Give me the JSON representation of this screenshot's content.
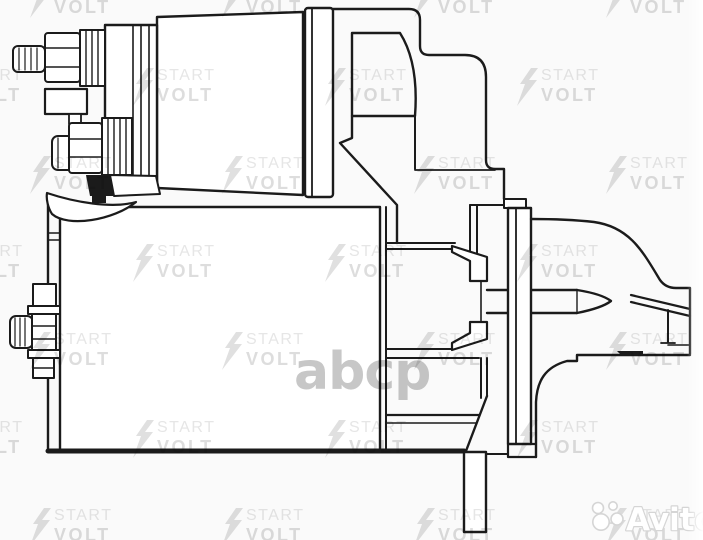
{
  "page": {
    "background": "#fafafa",
    "width": 703,
    "height": 540
  },
  "diagram": {
    "line_color": "#1b1b1b",
    "fill_color": "#ffffff"
  },
  "watermarks": {
    "startvolt": {
      "line1": "START",
      "line2": "VOLT",
      "line1_color": "#e6e6e6",
      "line2_color": "#dddddd",
      "bolt_color": "#e0e0e0",
      "grid": {
        "row_y_start": -20,
        "row_spacing": 88,
        "col_spacing": 192,
        "even_row_x": 30,
        "odd_row_x": 133,
        "rows": 7,
        "cols": 5
      }
    },
    "abcp": {
      "text": "abcp",
      "color": "#c7c7c7",
      "x": 294,
      "y": 346
    },
    "avito": {
      "text": "Avito",
      "text_color": "#ffffff",
      "outline_color": "#d5d5d5",
      "x": 626,
      "y": 530,
      "font_size": 31,
      "logo_circles": [
        {
          "cx": 598,
          "cy": 508,
          "r": 5.5
        },
        {
          "cx": 613,
          "cy": 506,
          "r": 4.2
        },
        {
          "cx": 601,
          "cy": 522,
          "r": 8.2
        },
        {
          "cx": 617,
          "cy": 519,
          "r": 6.0
        }
      ]
    }
  }
}
